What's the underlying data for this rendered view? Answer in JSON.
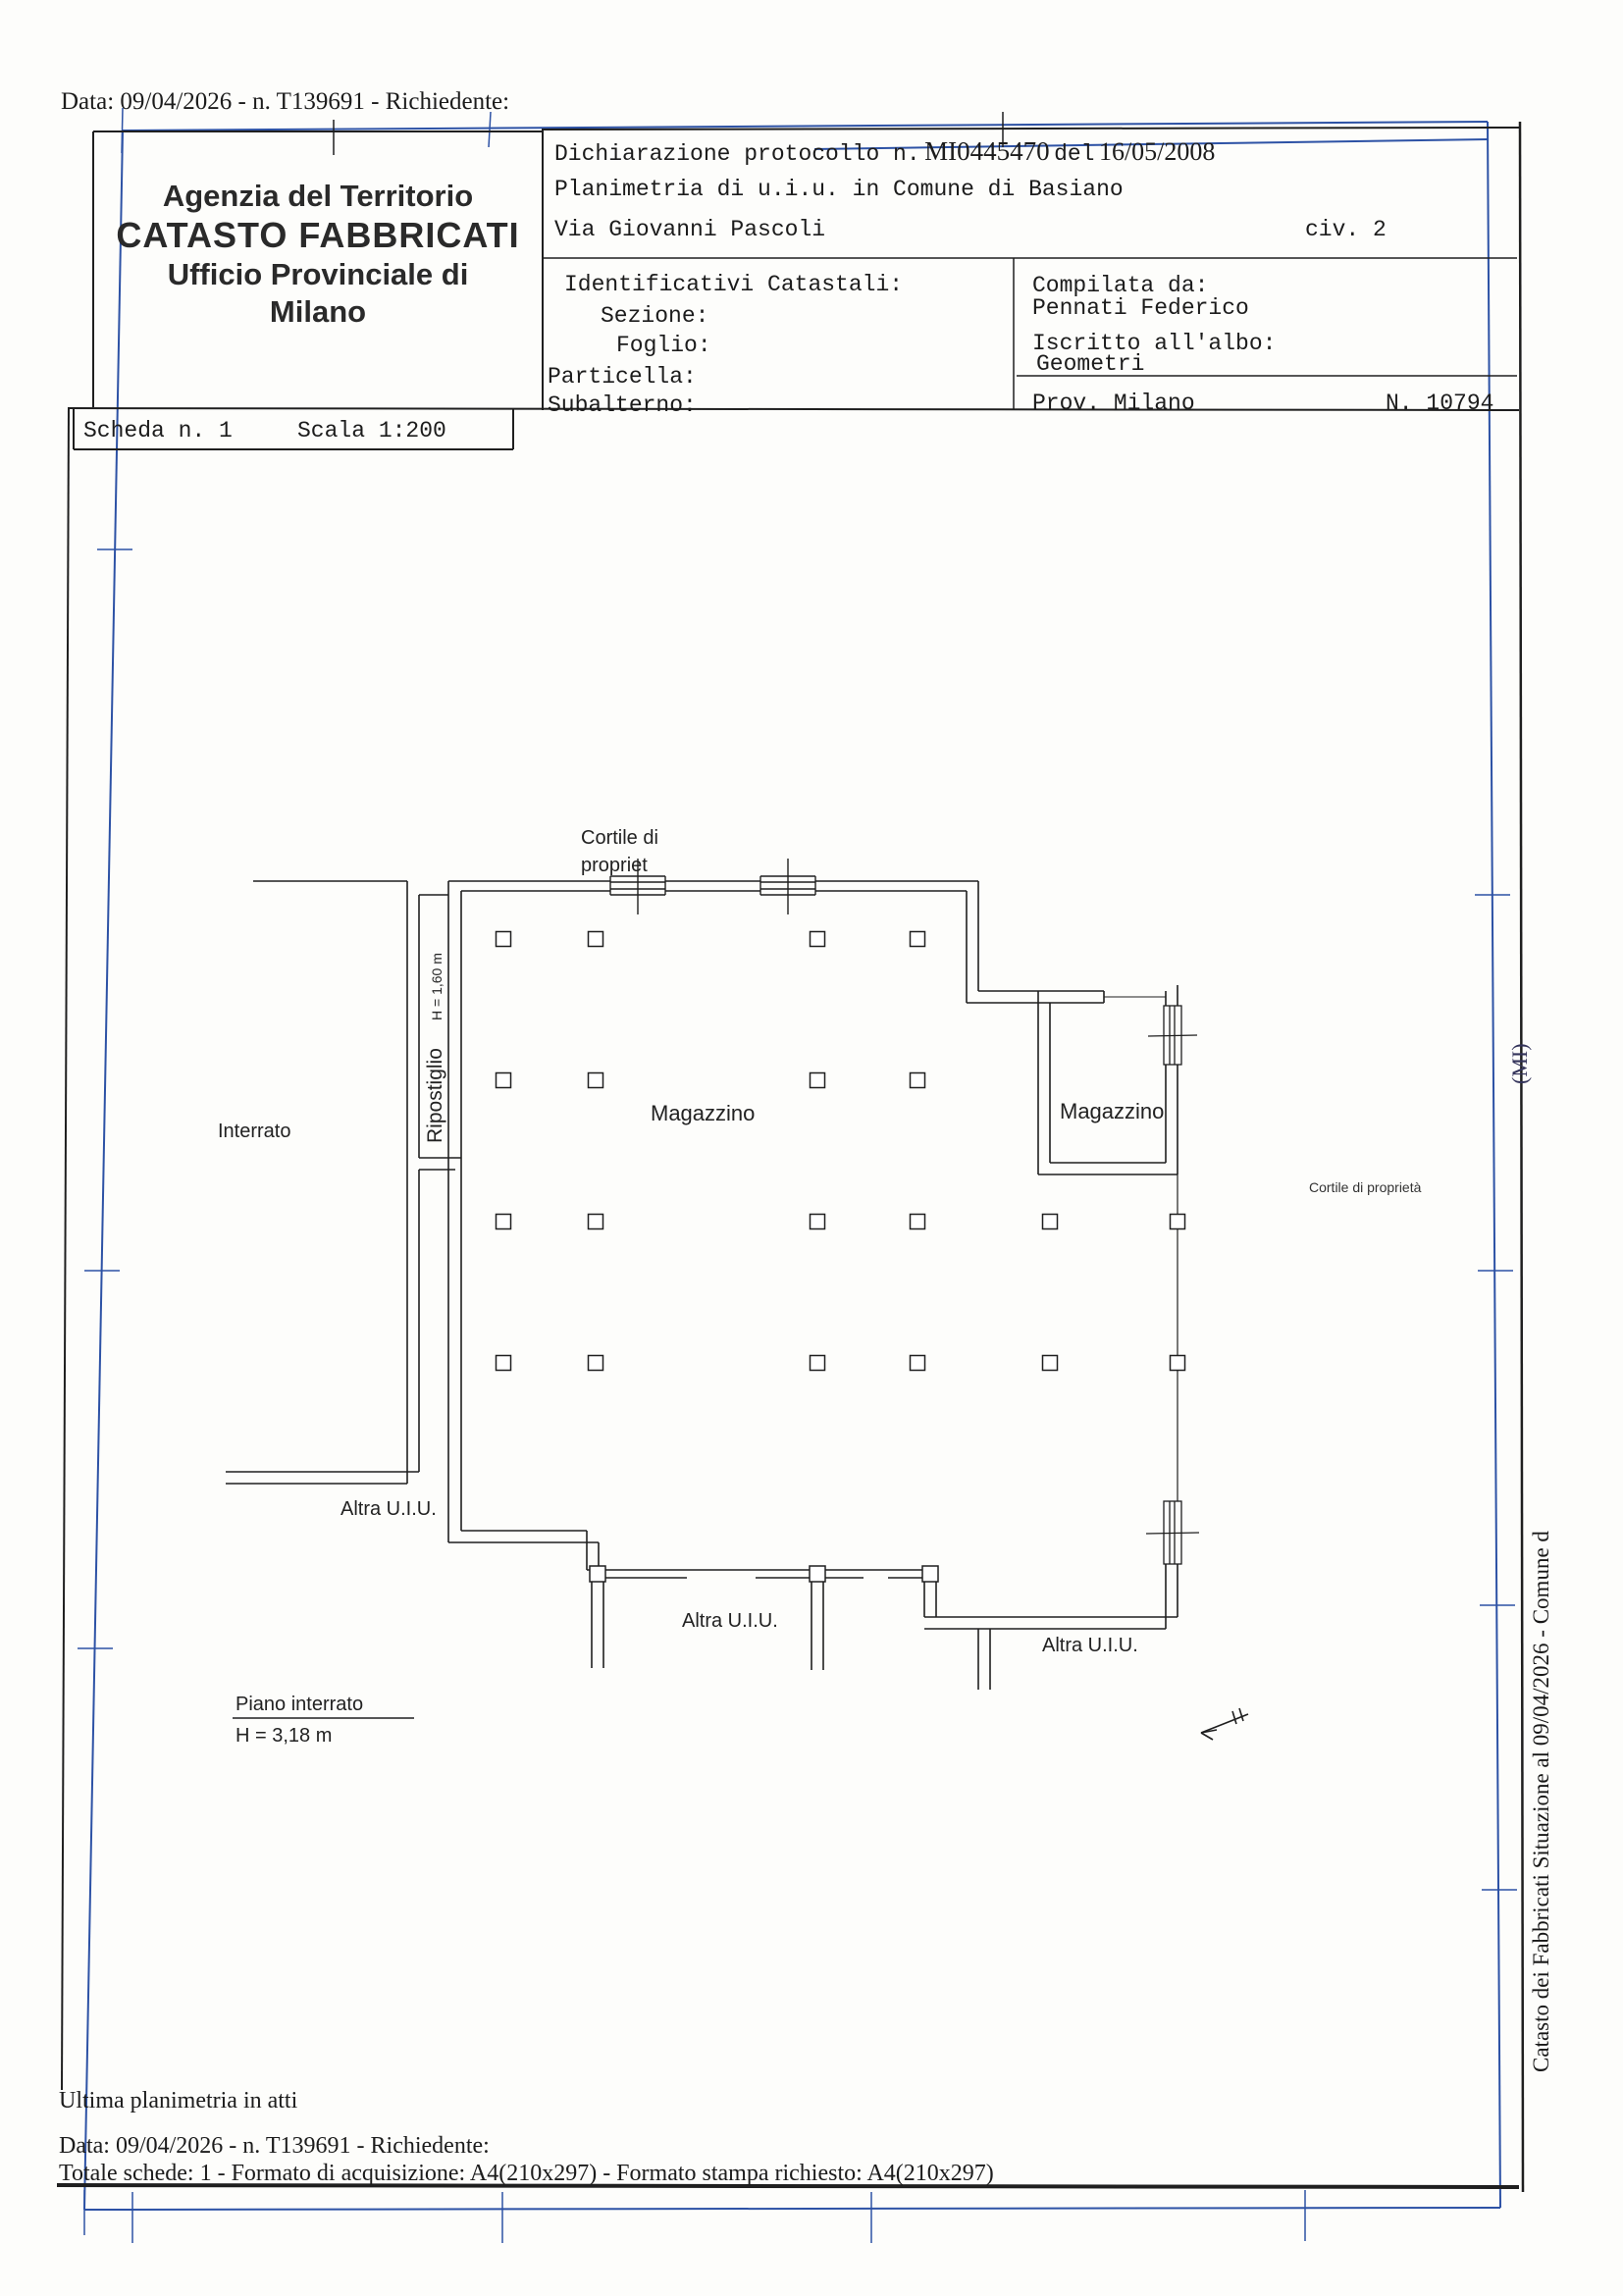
{
  "page": {
    "bg": "#fdfdfb",
    "ink": "#1c1c1c",
    "blue_border": "#2d52a5"
  },
  "top": {
    "date_line": "Data: 09/04/2026 - n. T139691 - Richiedente:"
  },
  "header_box": {
    "line1": "Agenzia del Territorio",
    "line2": "CATASTO FABBRICATI",
    "line3": "Ufficio Provinciale di",
    "line4": "Milano"
  },
  "protocol": {
    "prefix": "Dichiarazione protocollo n.",
    "number": "MI0445470",
    "del_word": "del",
    "date": "16/05/2008",
    "line2": "Planimetria di u.i.u. in Comune di Basiano",
    "street": "Via Giovanni Pascoli",
    "civ": "civ. 2"
  },
  "identificativi": {
    "title": "Identificativi Catastali:",
    "sezione": "Sezione:",
    "foglio": "Foglio:",
    "particella": "Particella:",
    "subalterno": "Subalterno:"
  },
  "compilata": {
    "label": "Compilata da:",
    "name": "Pennati Federico",
    "albo_label": "Iscritto all'albo:",
    "albo": "Geometri",
    "prov": "Prov. Milano",
    "num": "N. 10794"
  },
  "scheda": {
    "n": "Scheda n. 1",
    "scala": "Scala 1:200"
  },
  "plan": {
    "labels": {
      "cortile_line1": "Cortile di",
      "cortile_line2": "propriet",
      "interrato": "Interrato",
      "ripostiglio": "Ripostiglio",
      "h_ripostiglio": "H = 1,60 m",
      "magazzino_main": "Magazzino",
      "magazzino_small": "Magazzino",
      "cortile_right": "Cortile di proprietà",
      "altra_left": "Altra U.I.U.",
      "altra_center": "Altra U.I.U.",
      "altra_right": "Altra U.I.U.",
      "piano": "Piano interrato",
      "h_piano": "H = 3,18 m"
    }
  },
  "sidebar": {
    "vertical_text": "Catasto dei Fabbricati   Situazione al 09/04/2026 - Comune d",
    "fragment": "(MI)"
  },
  "footer": {
    "line1": "Ultima planimetria in atti",
    "line2": "Data: 09/04/2026 - n. T139691 - Richiedente:",
    "line3": "Totale schede: 1 - Formato di acquisizione: A4(210x297)  - Formato stampa richiesto: A4(210x297)"
  }
}
